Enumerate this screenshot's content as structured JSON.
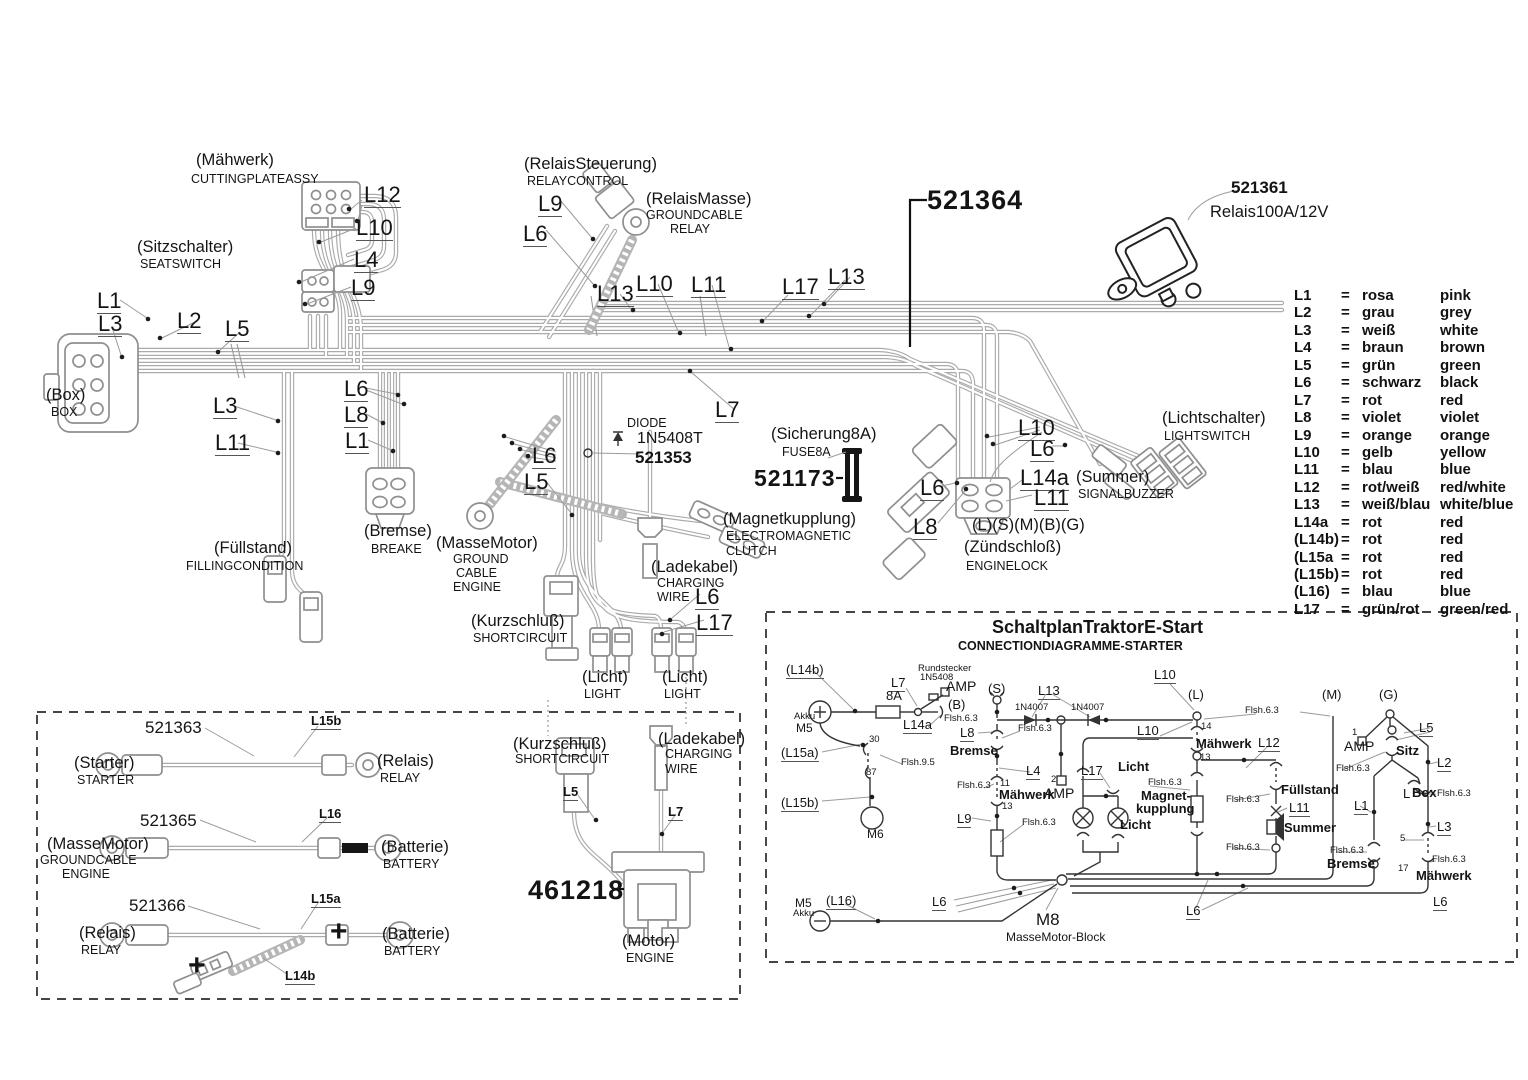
{
  "legend": {
    "rows": [
      {
        "code": "L1",
        "eq": "=",
        "de": "rosa",
        "en": "pink"
      },
      {
        "code": "L2",
        "eq": "=",
        "de": "grau",
        "en": "grey"
      },
      {
        "code": "L3",
        "eq": "=",
        "de": "weiß",
        "en": "white"
      },
      {
        "code": "L4",
        "eq": "=",
        "de": "braun",
        "en": "brown"
      },
      {
        "code": "L5",
        "eq": "=",
        "de": "grün",
        "en": "green"
      },
      {
        "code": "L6",
        "eq": "=",
        "de": "schwarz",
        "en": "black"
      },
      {
        "code": "L7",
        "eq": "=",
        "de": "rot",
        "en": "red"
      },
      {
        "code": "L8",
        "eq": "=",
        "de": "violet",
        "en": "violet"
      },
      {
        "code": "L9",
        "eq": "=",
        "de": "orange",
        "en": "orange"
      },
      {
        "code": "L10",
        "eq": "=",
        "de": "gelb",
        "en": "yellow"
      },
      {
        "code": "L11",
        "eq": "=",
        "de": "blau",
        "en": "blue"
      },
      {
        "code": "L12",
        "eq": "=",
        "de": "rot/weiß",
        "en": "red/white"
      },
      {
        "code": "L13",
        "eq": "=",
        "de": "weiß/blau",
        "en": "white/blue"
      },
      {
        "code": "L14a",
        "eq": "=",
        "de": "rot",
        "en": "red"
      },
      {
        "code": "(L14b)",
        "eq": "=",
        "de": "rot",
        "en": "red"
      },
      {
        "code": "(L15a",
        "eq": "=",
        "de": "rot",
        "en": "red"
      },
      {
        "code": "(L15b)",
        "eq": "=",
        "de": "rot",
        "en": "red"
      },
      {
        "code": "(L16)",
        "eq": "=",
        "de": "blau",
        "en": "blue"
      },
      {
        "code": "L17",
        "eq": "=",
        "de": "grün/rot",
        "en": "green/red"
      }
    ]
  },
  "labels": {
    "mahwerk_de": "(Mähwerk)",
    "mahwerk_en": "CUTTINGPLATEASSY",
    "l12_a": "L12",
    "l10_a": "L10",
    "l4_a": "L4",
    "l9_a": "L9",
    "sitz_de": "(Sitzschalter)",
    "sitz_en": "SEATSWITCH",
    "l1_a": "L1",
    "l3_a": "L3",
    "l2_a": "L2",
    "l5_a": "L5",
    "box_de": "(Box)",
    "box_en": "BOX",
    "l3_b": "L3",
    "l11_a": "L11",
    "l6_a": "L6",
    "l8_a": "L8",
    "l1_b": "L1",
    "relsteu_de": "(RelaisSteuerung)",
    "relsteu_en": "RELAYCONTROL",
    "l9_b": "L9",
    "l6_b": "L6",
    "relmasse_de": "(RelaisMasse)",
    "relmasse_en1": "GROUNDCABLE",
    "relmasse_en2": "RELAY",
    "l13_a": "L13",
    "l10_b": "L10",
    "l11_b": "L11",
    "l17_a": "L17",
    "l13_b": "L13",
    "pn_521364": "521364",
    "pn_521361": "521361",
    "relais100": "Relais100A/12V",
    "l7_a": "L7",
    "diode_t": "DIODE",
    "diode_pn": "1N5408T",
    "pn_521353": "521353",
    "sich_de": "(Sicherung8A)",
    "sich_en": "FUSE8A",
    "pn_521173": "521173",
    "magnet_de": "(Magnetkupplung)",
    "magnet_en1": "ELECTROMAGNETIC",
    "magnet_en2": "CLUTCH",
    "l6_c": "L6",
    "l8_b": "L8",
    "licht_de": "(Lichtschalter)",
    "licht_en": "LIGHTSWITCH",
    "l10_c": "L10",
    "l6_d": "L6",
    "l14a_a": "L14a",
    "l11_c": "L11",
    "summer_de": "(Summer)",
    "summer_en": "SIGNALBUZZER",
    "zuend_pins": "(L)(S)(M)(B)(G)",
    "zuend_de": "(Zündschloß)",
    "zuend_en": "ENGINELOCK",
    "bremse_de": "(Bremse)",
    "bremse_en": "BREAKE",
    "fuell_de": "(Füllstand)",
    "fuell_en": "FILLINGCONDITION",
    "mm1_de": "(MasseMotor)",
    "mm1_en1": "GROUND",
    "mm1_en2": "CABLE",
    "mm1_en3": "ENGINE",
    "l6_e": "L6",
    "l5_b": "L5",
    "kurz1_de": "(Kurzschluß)",
    "kurz1_en": "SHORTCIRCUIT",
    "lade1_de": "(Ladekabel)",
    "lade1_en1": "CHARGING",
    "lade1_en2": "WIRE",
    "l6_f": "L6",
    "l17_b": "L17",
    "licht1_de": "(Licht)",
    "licht1_en": "LIGHT",
    "licht2_de": "(Licht)",
    "licht2_en": "LIGHT",
    "pn_521363": "521363",
    "l15b_a": "L15b",
    "starter_de": "(Starter)",
    "starter_en": "STARTER",
    "relais1_de": "(Relais)",
    "relais1_en": "RELAY",
    "pn_521365": "521365",
    "l16_a": "L16",
    "mm2_de": "(MasseMotor)",
    "mm2_en1": "GROUNDCABLE",
    "mm2_en2": "ENGINE",
    "batt1_de": "(Batterie)",
    "batt1_en": "BATTERY",
    "pn_521366": "521366",
    "l15a_a": "L15a",
    "relais2_de": "(Relais)",
    "relais2_en": "RELAY",
    "batt2_de": "(Batterie)",
    "batt2_en": "BATTERY",
    "plus1": "+",
    "plus2": "+",
    "l14b_a": "L14b",
    "kurz2_de": "(Kurzschluß)",
    "kurz2_en": "SHORTCIRCUIT",
    "lade2_de": "(Ladekabel)",
    "lade2_en1": "CHARGING",
    "lade2_en2": "WIRE",
    "l5_c": "L5",
    "l7_b": "L7",
    "pn_461218": "461218",
    "motor_de": "(Motor)",
    "motor_en": "ENGINE",
    "schem_title": "SchaltplanTraktorE-Start",
    "schem_sub": "CONNECTIONDIAGRAMME-STARTER",
    "s_l14b": "(L14b)",
    "s_l7": "L7",
    "s_rund1": "Rundstecker",
    "s_rund2": "1N5408",
    "s_amp1": "AMP",
    "s_8a": "8A",
    "s_b": "(B)",
    "s_akku1": "Akku",
    "s_m5a": "M5",
    "s_l14a": "L14a",
    "s_flsh1": "Flsh.6.3",
    "s_s": "(S)",
    "s_l13": "L13",
    "s_d1": "1N4007",
    "s_d2": "1N4007",
    "s_l8": "L8",
    "s_flsh2": "Flsh.6.3",
    "s_bremse1": "Bremse",
    "s_l15a": "(L15a)",
    "s_30": "30",
    "s_flsh95": "Flsh.9.5",
    "s_87": "87",
    "s_l15b": "(L15b)",
    "s_m6": "M6",
    "s_l4": "L4",
    "s_flsh3": "Flsh.6.3",
    "s_11": "11",
    "s_maeh1": "Mähwerk",
    "s_2": "2",
    "s_amp2": "AMP",
    "s_l17": "L17",
    "s_licht1": "Licht",
    "s_13a": "13",
    "s_l9": "L9",
    "s_flsh4": "Flsh.6.3",
    "s_licht2": "Licht",
    "s_l10a": "L10",
    "s_L": "(L)",
    "s_M": "(M)",
    "s_G": "(G)",
    "s_flsh5": "Flsh.6.3",
    "s_l10b": "L10",
    "s_14": "14",
    "s_maeh2": "Mähwerk",
    "s_l12": "L12",
    "s_13b": "13",
    "s_flsh6": "Flsh.6.3",
    "s_magnet1": "Magnet-",
    "s_magnet2": "kupplung",
    "s_fuell": "Füllstand",
    "s_flsh7": "Flsh.6.3",
    "s_l11": "L11",
    "s_summer": "Summer",
    "s_flsh8": "Flsh.6.3",
    "s_l1": "L1",
    "s_Lp": "L",
    "s_box": "Box",
    "s_flsh9": "Flsh.6.3",
    "s_l2": "L2",
    "s_l5": "L5",
    "s_1": "1",
    "s_amp3": "AMP",
    "s_sitz": "Sitz",
    "s_flsh10": "Flsh.6.3",
    "s_l3": "L3",
    "s_5": "5",
    "s_flsh11": "Flsh.6.3",
    "s_bremse2": "Bremse",
    "s_flsh12": "Flsh.6.3",
    "s_17": "17",
    "s_maeh3": "Mähwerk",
    "s_l6a": "L6",
    "s_l6b": "L6",
    "s_l6c": "L6",
    "s_m5b": "M5",
    "s_akku2": "Akku",
    "s_l16": "(L16)",
    "s_m8": "M8",
    "s_mmblock": "MasseMotor-Block"
  }
}
